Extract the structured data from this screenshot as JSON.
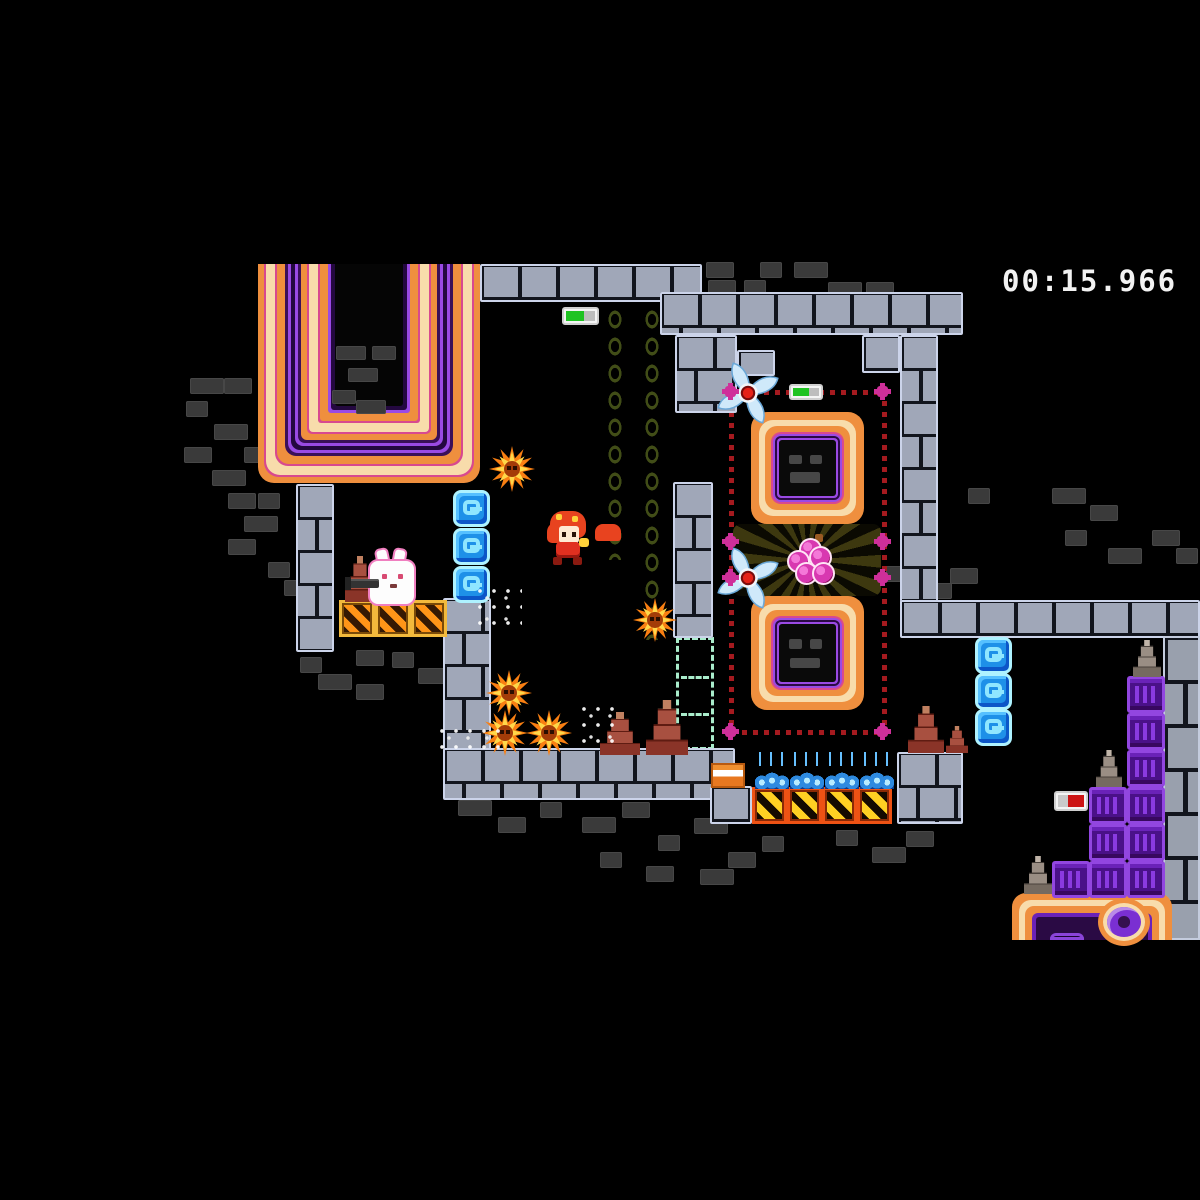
{
  "hud": {
    "timer": "00:15.966"
  },
  "colors": {
    "background": "#000000",
    "brick_light": "#a0a7b8",
    "brick_dark": "#3a3a3a",
    "neon_orange": "#ef8f3e",
    "neon_cream": "#f8dcab",
    "neon_magenta": "#d8498f",
    "neon_purple": "#9a4ae4",
    "dot_red": "#a51a1f",
    "node_pink": "#cf2f9a",
    "ice_blue": "#1e90e8",
    "indicator_green": "#1fc322",
    "indicator_red": "#cc1414",
    "crate_yellow": "#f2b93c",
    "crate_orange": "#ee5214",
    "purple_crate": "#9246e0",
    "star_orange": "#f97f12",
    "timer_text": "#f2f2f2"
  },
  "scene": {
    "walls": [
      {
        "name": "band-top-left",
        "r": [
          480,
          264,
          222,
          38
        ]
      },
      {
        "name": "band-top-right",
        "r": [
          660,
          292,
          303,
          43
        ]
      },
      {
        "name": "pillar-top-mid",
        "r": [
          675,
          335,
          62,
          78
        ]
      },
      {
        "name": "brick-jut",
        "r": [
          737,
          350,
          38,
          26
        ]
      },
      {
        "name": "arm-right",
        "r": [
          862,
          335,
          38,
          38
        ]
      },
      {
        "name": "pillar-right",
        "r": [
          900,
          335,
          38,
          300
        ]
      },
      {
        "name": "floor-right",
        "r": [
          900,
          600,
          300,
          38
        ]
      },
      {
        "name": "pillar-left",
        "r": [
          296,
          484,
          38,
          168
        ]
      },
      {
        "name": "pillar-bottom-left",
        "r": [
          443,
          598,
          48,
          152
        ]
      },
      {
        "name": "floor-bottom",
        "r": [
          443,
          748,
          292,
          52
        ]
      },
      {
        "name": "pillar-mid",
        "r": [
          673,
          482,
          40,
          156
        ]
      },
      {
        "name": "patch-under-block",
        "r": [
          710,
          786,
          42,
          38
        ]
      },
      {
        "name": "patch-cones",
        "r": [
          897,
          752,
          66,
          72
        ]
      }
    ],
    "walls_big": [
      {
        "name": "wall-right-edge",
        "r": [
          1163,
          636,
          37,
          304
        ]
      }
    ],
    "dark_bricks": [
      [
        190,
        378
      ],
      [
        224,
        378
      ],
      [
        186,
        401
      ],
      [
        214,
        424
      ],
      [
        184,
        447
      ],
      [
        244,
        447
      ],
      [
        212,
        470
      ],
      [
        228,
        493
      ],
      [
        258,
        493
      ],
      [
        244,
        516
      ],
      [
        228,
        539
      ],
      [
        268,
        562
      ],
      [
        284,
        580
      ],
      [
        356,
        650
      ],
      [
        392,
        652
      ],
      [
        418,
        668
      ],
      [
        356,
        684
      ],
      [
        300,
        657
      ],
      [
        318,
        674
      ],
      [
        706,
        262
      ],
      [
        760,
        262
      ],
      [
        794,
        262
      ],
      [
        708,
        280
      ],
      [
        744,
        280
      ],
      [
        828,
        282
      ],
      [
        866,
        282
      ],
      [
        968,
        488
      ],
      [
        1052,
        488
      ],
      [
        1090,
        505
      ],
      [
        886,
        566
      ],
      [
        918,
        583
      ],
      [
        950,
        568
      ],
      [
        1065,
        530
      ],
      [
        1108,
        548
      ],
      [
        1152,
        530
      ],
      [
        1176,
        548
      ],
      [
        458,
        800
      ],
      [
        498,
        817
      ],
      [
        540,
        802
      ],
      [
        582,
        817
      ],
      [
        622,
        802
      ],
      [
        658,
        835
      ],
      [
        694,
        818
      ],
      [
        728,
        852
      ],
      [
        762,
        836
      ],
      [
        700,
        869
      ],
      [
        646,
        866
      ],
      [
        836,
        830
      ],
      [
        872,
        847
      ],
      [
        906,
        831
      ],
      [
        600,
        852
      ]
    ],
    "dark_bricks_over": [
      [
        336,
        346
      ],
      [
        372,
        346
      ],
      [
        348,
        368
      ],
      [
        332,
        390
      ],
      [
        356,
        400
      ]
    ],
    "tube": {
      "r": [
        258,
        264,
        222,
        219
      ]
    },
    "squares": [
      {
        "r": [
          751,
          412,
          113,
          112
        ]
      },
      {
        "r": [
          751,
          596,
          113,
          114
        ]
      }
    ],
    "machine": {
      "r": [
        1012,
        893,
        160,
        47
      ]
    },
    "dotted": {
      "h": [
        [
          731,
          390,
          156
        ],
        [
          731,
          540,
          156
        ],
        [
          731,
          576,
          156
        ],
        [
          731,
          730,
          156
        ]
      ],
      "v": [
        [
          729,
          390,
          345
        ],
        [
          882,
          390,
          345
        ]
      ],
      "flowers": [
        [
          725,
          386
        ],
        [
          877,
          386
        ],
        [
          725,
          536
        ],
        [
          877,
          536
        ],
        [
          725,
          572
        ],
        [
          877,
          572
        ],
        [
          725,
          726
        ],
        [
          877,
          726
        ]
      ]
    },
    "burst": {
      "r": [
        733,
        524,
        148,
        72
      ]
    },
    "grapes": {
      "r": [
        785,
        534,
        54,
        54
      ]
    },
    "shurikens": [
      [
        715,
        360
      ],
      [
        715,
        545
      ]
    ],
    "stars": [
      [
        489,
        446,
        46
      ],
      [
        633,
        598,
        44
      ],
      [
        486,
        670,
        46
      ],
      [
        482,
        710,
        46
      ],
      [
        526,
        710,
        46
      ]
    ],
    "ghost": {
      "r": [
        676,
        637,
        38,
        113
      ]
    },
    "chains": [
      [
        604,
        306,
        254
      ],
      [
        641,
        306,
        334
      ]
    ],
    "g_blocks": [
      [
        453,
        490
      ],
      [
        453,
        528
      ],
      [
        453,
        566
      ],
      [
        975,
        637
      ],
      [
        975,
        673
      ],
      [
        975,
        709
      ]
    ],
    "crates_a": [
      [
        339,
        600
      ],
      [
        375,
        600
      ],
      [
        411,
        600
      ]
    ],
    "crates_b": [
      [
        752,
        787
      ],
      [
        787,
        787
      ],
      [
        822,
        787
      ],
      [
        857,
        787
      ]
    ],
    "purple_blocks": [
      [
        1127,
        676
      ],
      [
        1127,
        713
      ],
      [
        1127,
        750
      ],
      [
        1127,
        787
      ],
      [
        1127,
        824
      ],
      [
        1127,
        861
      ],
      [
        1089,
        787
      ],
      [
        1089,
        824
      ],
      [
        1089,
        861
      ],
      [
        1052,
        861
      ]
    ],
    "cones": [
      {
        "r": [
          345,
          556,
          30,
          46
        ],
        "variant": "red"
      },
      {
        "r": [
          600,
          712,
          40,
          43
        ],
        "variant": "red"
      },
      {
        "r": [
          646,
          700,
          42,
          55
        ],
        "variant": "red"
      },
      {
        "r": [
          908,
          706,
          36,
          47
        ],
        "variant": "red"
      },
      {
        "r": [
          946,
          726,
          22,
          27
        ],
        "variant": "red"
      },
      {
        "r": [
          1133,
          640,
          28,
          37
        ],
        "variant": "gray"
      },
      {
        "r": [
          1096,
          750,
          26,
          37
        ],
        "variant": "gray"
      },
      {
        "r": [
          1024,
          856,
          28,
          38
        ],
        "variant": "gray"
      }
    ],
    "teslas": [
      [
        755,
        763
      ],
      [
        790,
        763
      ],
      [
        825,
        763
      ],
      [
        860,
        763
      ]
    ],
    "striped_block": {
      "r": [
        711,
        763,
        34,
        25
      ]
    },
    "rabbit": {
      "r": [
        352,
        552,
        66,
        50
      ]
    },
    "player": {
      "r": [
        543,
        511,
        50,
        55
      ]
    },
    "indicators": [
      {
        "name": "switch-indicator-green",
        "r": [
          562,
          307,
          37,
          18
        ],
        "segments": [
          {
            "color": "#1fc322",
            "pct": 62
          },
          {
            "color": "#bdbdbd",
            "pct": 38
          }
        ]
      },
      {
        "name": "switch-indicator-green",
        "r": [
          789,
          384,
          34,
          16
        ],
        "segments": [
          {
            "color": "#1fc322",
            "pct": 62
          },
          {
            "color": "#bdbdbd",
            "pct": 38
          }
        ]
      },
      {
        "name": "switch-indicator-red",
        "r": [
          1054,
          791,
          34,
          20
        ],
        "segments": [
          {
            "color": "#c9c9c9",
            "pct": 38
          },
          {
            "color": "#cc1414",
            "pct": 62
          }
        ]
      }
    ],
    "particles": [
      [
        478,
        588,
        44,
        40
      ],
      [
        582,
        706,
        40,
        48
      ],
      [
        440,
        728,
        64,
        28
      ]
    ]
  }
}
